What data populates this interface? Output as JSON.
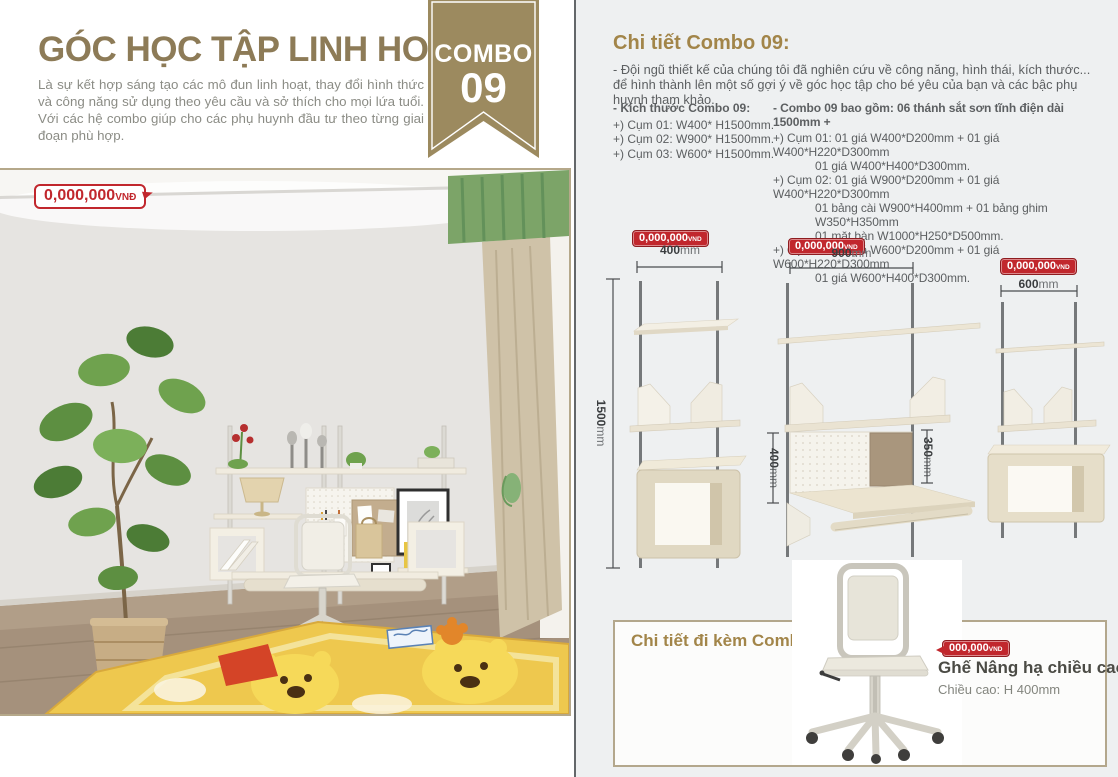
{
  "colors": {
    "accent_brown": "#a28549",
    "title_brown": "#8d7b57",
    "ribbon_tan": "#9c8a5f",
    "price_red": "#c1272d",
    "panel_bg": "#eef0f1",
    "box_border": "#b3a78c"
  },
  "left": {
    "title": "GÓC HỌC TẬP LINH HOẠT",
    "description": "Là sự kết hợp sáng tạo các mô đun linh hoạt, thay đổi hình thức và công năng sử dụng theo yêu cầu và sở thích cho mọi lứa tuổi. Với các hệ combo giúp cho các phụ huynh đầu tư theo từng giai đoạn phù hợp.",
    "ribbon": {
      "line1": "COMBO",
      "line2": "09"
    },
    "photo_price": {
      "amount": "0,000,000",
      "currency": "VNĐ"
    }
  },
  "right": {
    "heading": "Chi tiết Combo 09:",
    "intro": {
      "line1": "- Đội ngũ thiết kế của chúng tôi đã nghiên cứu về công năng, hình thái, kích thước...",
      "line2": "để hình thành lên một số gợi ý về góc học tập cho bé yêu của bạn và các bậc phụ huynh tham khảo."
    },
    "sizes": {
      "heading": "- Kích thước Combo 09:",
      "items": [
        "+) Cụm 01: W400* H1500mm.",
        "+) Cụm 02: W900* H1500mm.",
        "+) Cụm 03: W600* H1500mm."
      ]
    },
    "includes": {
      "heading": "- Combo 09 bao gồm: 06 thánh sắt sơn tĩnh điện dài 1500mm +",
      "lines": [
        "+) Cụm 01: 01 giá W400*D200mm + 01 giá W400*H220*D300mm",
        "01 giá W400*H400*D300mm.",
        "+) Cụm 02: 01 giá W900*D200mm + 01 giá W400*H220*D300mm",
        "01 bảng cài W900*H400mm + 01 bảng ghim W350*H350mm",
        "01 mặt bàn W1000*H250*D500mm.",
        "+) Cụm 03: 01 giá W600*D200mm + 01 giá W600*H220*D300mm",
        "01 giá W600*H400*D300mm."
      ]
    },
    "diagrams": {
      "d1": {
        "price": {
          "amount": "0,000,000",
          "currency": "VND"
        },
        "width": {
          "value": "400",
          "unit": "mm"
        },
        "height": {
          "value": "1500",
          "unit": "mm"
        }
      },
      "d2": {
        "price": {
          "amount": "0,000,000",
          "currency": "VND"
        },
        "width": {
          "value": "900",
          "unit": "mm"
        },
        "board_height": {
          "value": "400",
          "unit": "mm"
        },
        "pin_height": {
          "value": "350",
          "unit": "mm"
        }
      },
      "d3": {
        "price": {
          "amount": "0,000,000",
          "currency": "VND"
        },
        "width": {
          "value": "600",
          "unit": "mm"
        }
      }
    },
    "accessory": {
      "heading": "Chi tiết đi kèm Combo 09:",
      "price": {
        "amount": "000,000",
        "currency": "VND"
      },
      "name": "Ghế Nâng hạ chiều cao",
      "spec": "Chiều cao: H 400mm"
    }
  }
}
